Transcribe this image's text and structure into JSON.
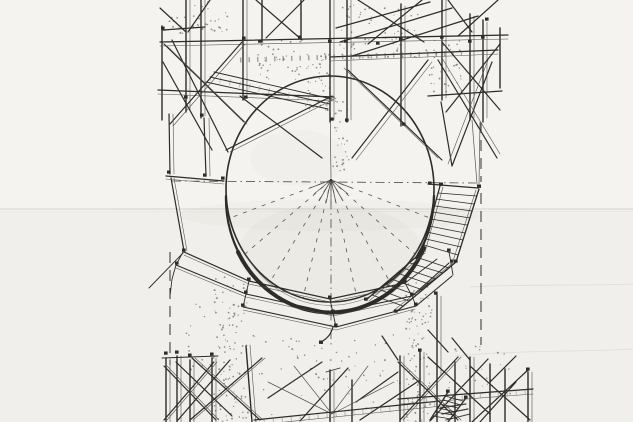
{
  "page": {
    "title": "Hand-drawn ink perspective sketch: circular opening (oculus) ringed by a suspended timber walkway and stair, with dense timber scaffolding above and below"
  },
  "palette": {
    "paper": "#f4f3f0",
    "paper-lower": "#f0efeb",
    "ink": "#2e2c29",
    "ink-soft": "#56544f",
    "pencil": "#b8b6b0",
    "crease": "#d3d2ce",
    "wash": "#8a887f"
  },
  "labels": {
    "canvas": "scanned pen sketch on paper",
    "upper_scaffold": "timber scaffolding above the opening",
    "circular_opening": "large circular opening drawn thick at its lower rim",
    "vanishing_fan": "vanishing point with radiating dash-dot perspective guides",
    "walkway_ring": "faceted three-tier walkway ring hung around the lower rim",
    "staircase": "two-flight access stair descending along the right rim",
    "lower_scaffold": "timber scaffolding and plank courses below",
    "guides": "dashed vertical construction guide lines",
    "stipple": "stippled concrete pier texture",
    "horizon": "faint horizon crease across the sheet"
  }
}
